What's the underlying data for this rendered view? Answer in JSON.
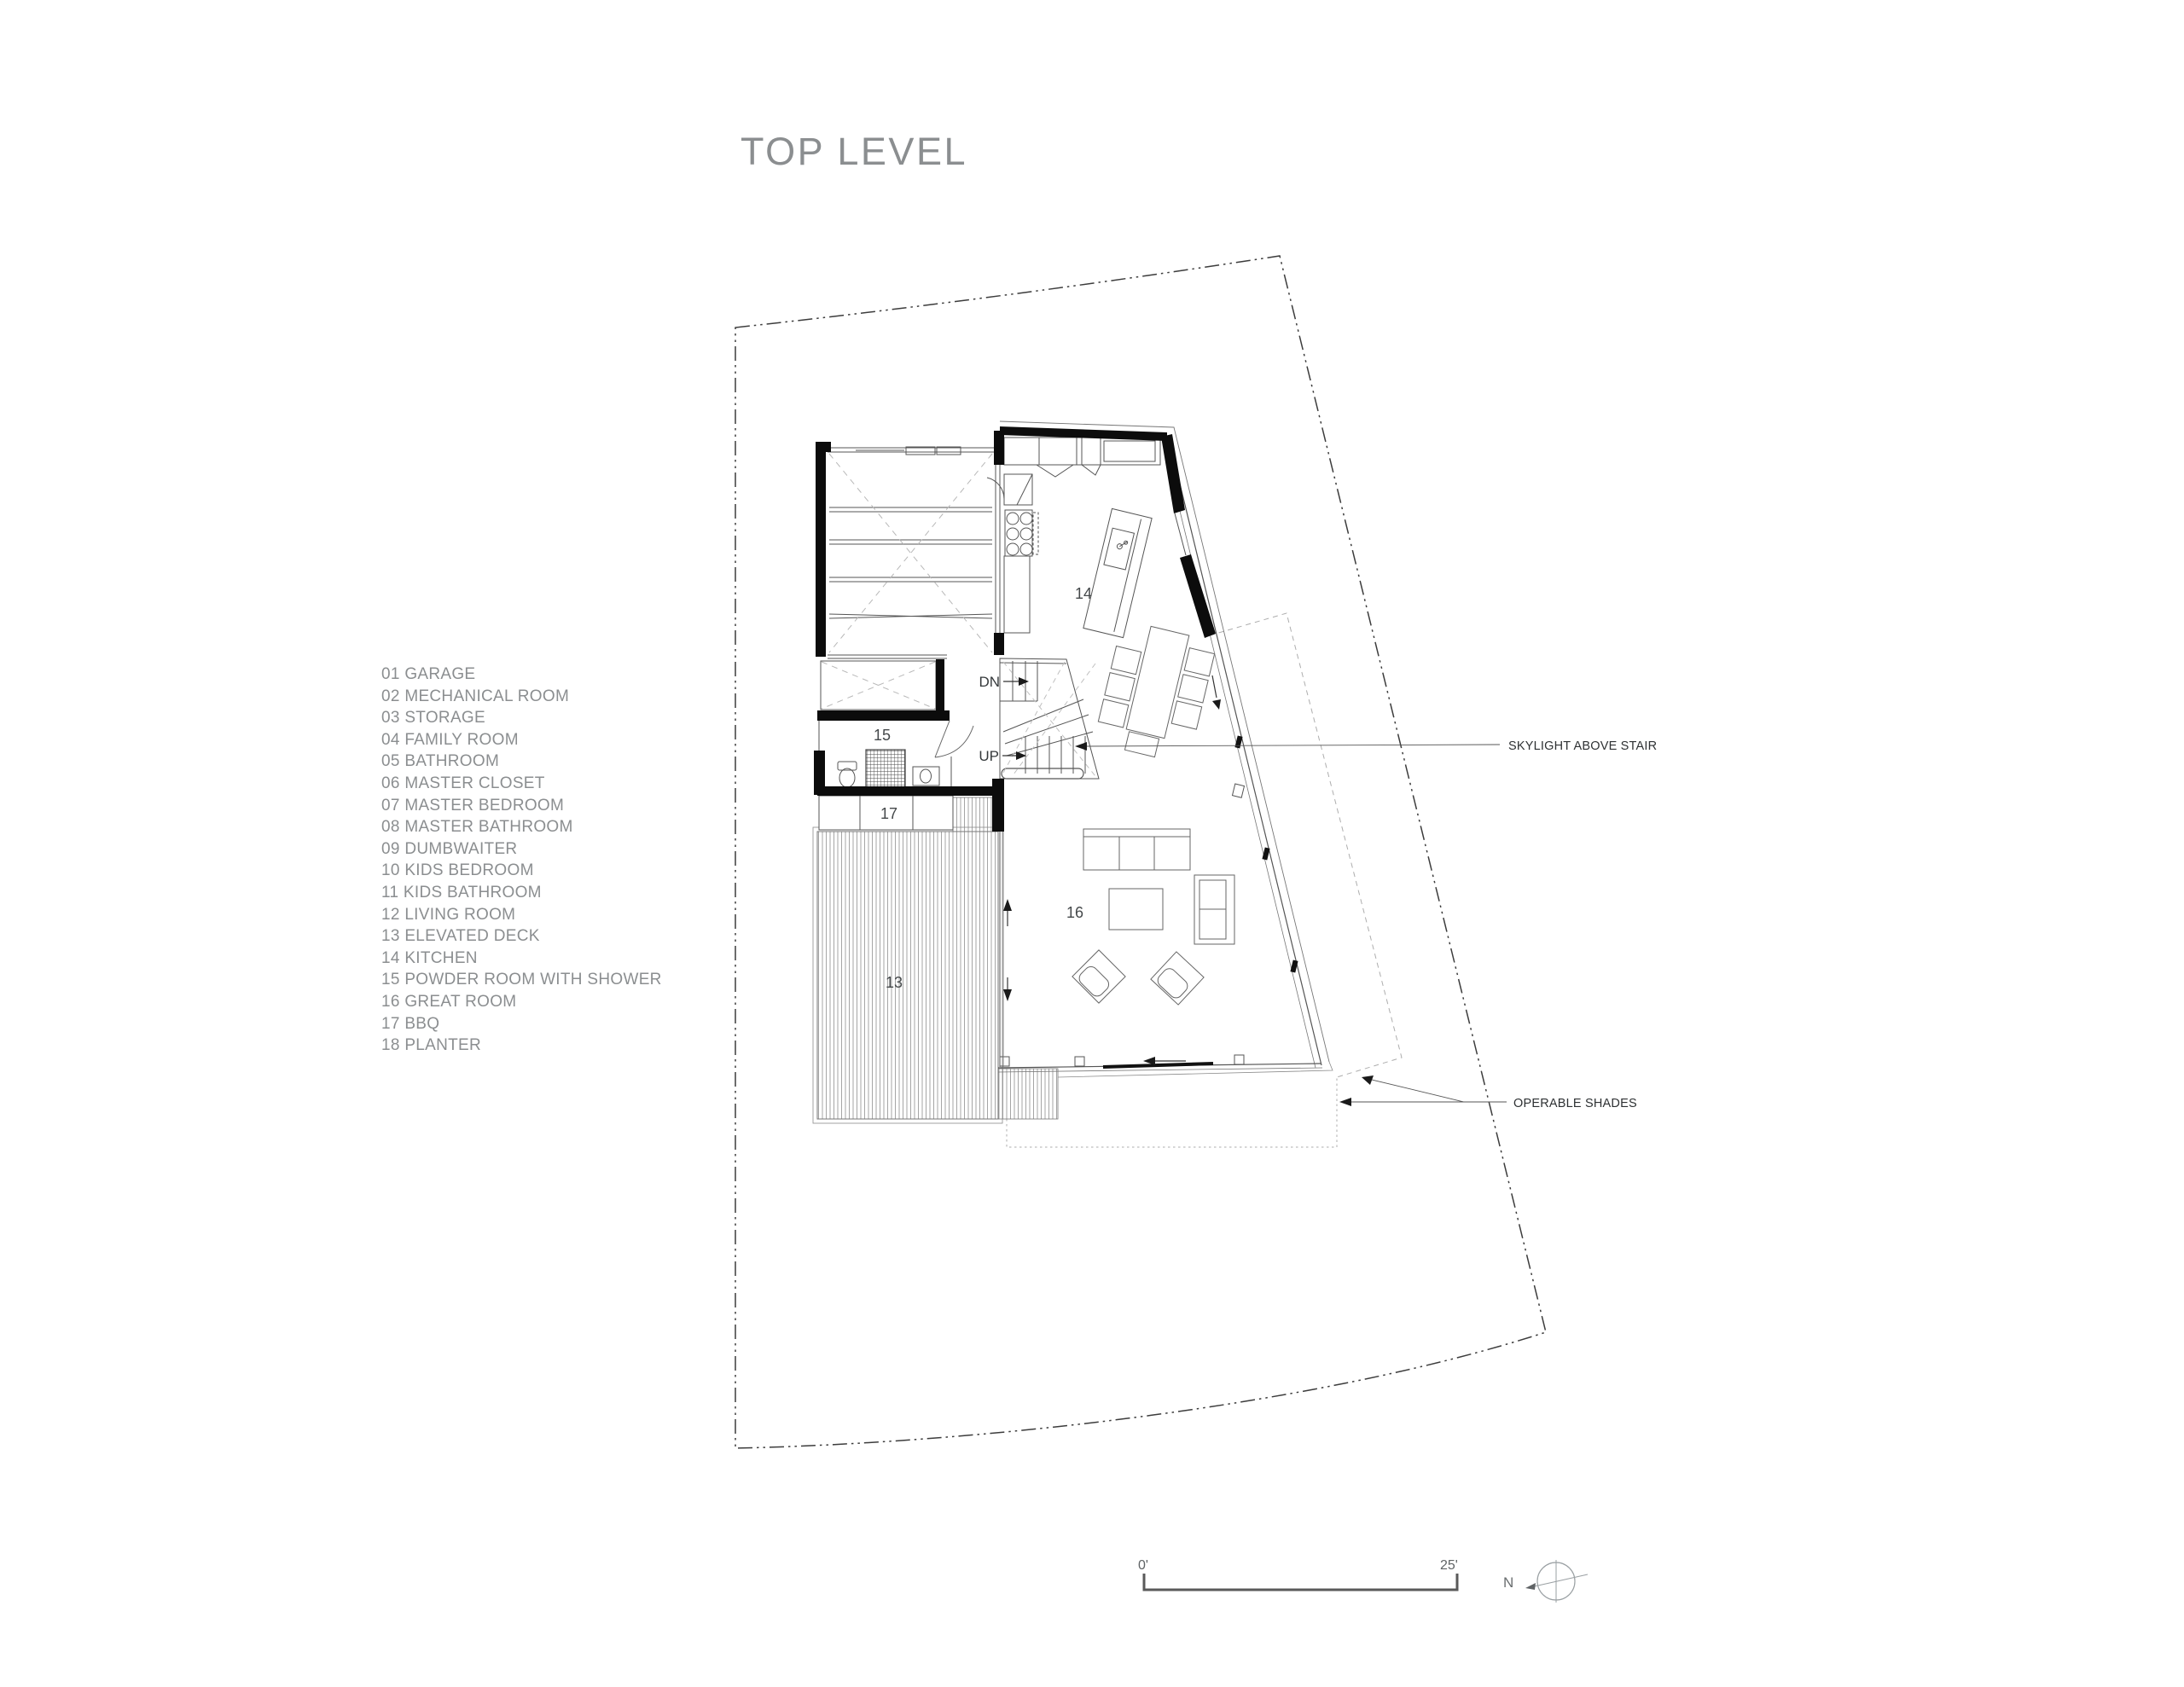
{
  "title": "TOP LEVEL",
  "legend": {
    "items": [
      "01 GARAGE",
      "02 MECHANICAL ROOM",
      "03 STORAGE",
      "04 FAMILY ROOM",
      "05 BATHROOM",
      "06 MASTER CLOSET",
      "07 MASTER BEDROOM",
      "08 MASTER BATHROOM",
      "09 DUMBWAITER",
      "10 KIDS BEDROOM",
      "11 KIDS BATHROOM",
      "12 LIVING ROOM",
      "13 ELEVATED DECK",
      "14 KITCHEN",
      "15 POWDER ROOM WITH SHOWER",
      "16 GREAT ROOM",
      "17 BBQ",
      "18 PLANTER"
    ]
  },
  "plan": {
    "room_labels": {
      "deck": "13",
      "kitchen": "14",
      "powder_room": "15",
      "great_room": "16",
      "bbq": "17"
    },
    "stair_labels": {
      "down": "DN",
      "up": "UP"
    }
  },
  "annotations": {
    "skylight": "SKYLIGHT ABOVE STAIR",
    "shades": "OPERABLE SHADES"
  },
  "scale_bar": {
    "start": "0'",
    "end": "25'"
  },
  "compass": {
    "north": "N"
  },
  "colors": {
    "wall": "#0c0c0c",
    "line": "#4d4d4d",
    "text_gray": "#8b8e90",
    "property_line": "#3c3c3c"
  }
}
